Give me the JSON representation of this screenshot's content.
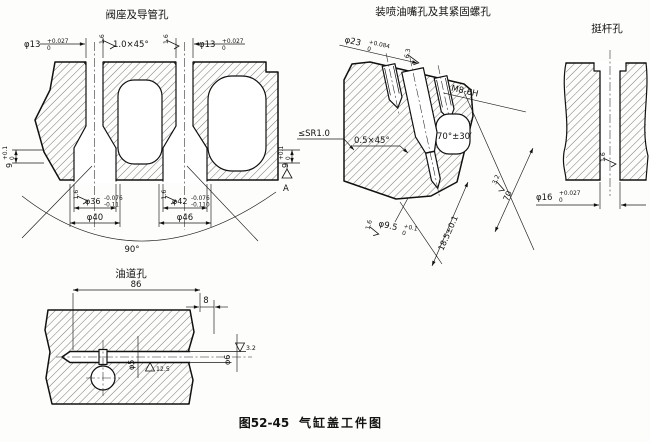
{
  "caption": {
    "prefix": "图52-45",
    "title": "气缸盖工件图"
  },
  "roughness": {
    "r16": "1.6",
    "r63": "6.3",
    "r32": "3.2",
    "r125": "12.5"
  },
  "views": {
    "valve_seat": {
      "title": "阀座及导管孔",
      "guide_left": {
        "main": "φ13",
        "sup": "+0.027",
        "sub": "0"
      },
      "guide_right": {
        "main": "φ13",
        "sup": "+0.027",
        "sub": "0"
      },
      "chamfer": "1.0×45°",
      "depth_left": {
        "main": "9",
        "sup": "+0.1",
        "sub": "0"
      },
      "depth_right": {
        "main": "9",
        "sup": "+0.1",
        "sub": "0"
      },
      "seat_left": {
        "main": "φ36",
        "sup": "-0.076",
        "sub": "-0.11"
      },
      "seat_left_od": "φ40",
      "seat_right": {
        "main": "φ42",
        "sup": "-0.076",
        "sub": "-0.110"
      },
      "seat_right_od": "φ46",
      "seat_angle": "90°",
      "datum": "A",
      "sphere_note": "≤SR1.0"
    },
    "injector": {
      "title": "装喷油嘴孔及其紧固螺孔",
      "bore": {
        "main": "φ23",
        "sup": "+0.084",
        "sub": "0"
      },
      "thread": "M8-6H",
      "chamfer": "0.5×45°",
      "cone_angle": "70°±30′",
      "tip": {
        "main": "φ9.5",
        "sup": "+0.1",
        "sub": "0"
      },
      "depth": "18.5±0.1",
      "length": "70"
    },
    "tappet": {
      "title": "挺杆孔",
      "bore": {
        "main": "φ16",
        "sup": "+0.027",
        "sub": "0"
      }
    },
    "oil": {
      "title": "油道孔",
      "length": "86",
      "offset": "8",
      "main_dia": "φ5",
      "end_dia": "φ6"
    }
  }
}
